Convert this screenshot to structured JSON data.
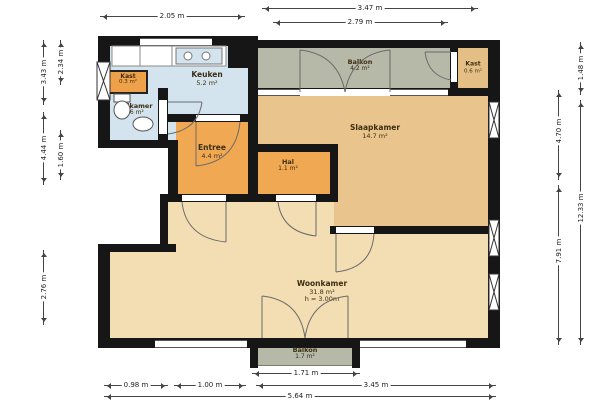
{
  "floorplan": {
    "rooms": {
      "kast_left": {
        "name": "Kast",
        "area": "0.3 m²"
      },
      "keuken": {
        "name": "Keuken",
        "area": "5.2 m²"
      },
      "badkamer": {
        "name": "Badkamer",
        "area": "2.6 m²"
      },
      "entree": {
        "name": "Entree",
        "area": "4.4 m²"
      },
      "hal": {
        "name": "Hal",
        "area": "1.1 m²"
      },
      "slaapkamer": {
        "name": "Slaapkamer",
        "area": "14.7 m²"
      },
      "balkon_top": {
        "name": "Balkon",
        "area": "4.2 m²"
      },
      "kast_right": {
        "name": "Kast",
        "area": "0.6 m²"
      },
      "woonkamer": {
        "name": "Woonkamer",
        "area": "31.8 m²",
        "height_note": "h = 3.00m"
      },
      "balkon_bottom": {
        "name": "Balkon",
        "area": "1.7 m²"
      }
    },
    "dims": {
      "top": [
        "2.05 m",
        "3.47 m",
        "2.79 m"
      ],
      "bottom": [
        "1.71 m",
        "0.98 m",
        "1.00 m",
        "3.45 m",
        "5.64 m"
      ],
      "left": [
        "2.34 m",
        "3.43 m",
        "4.44 m",
        "1.60 m",
        "2.76 m"
      ],
      "right": [
        "1.48 m",
        "4.70 m",
        "12.33 m",
        "7.91 m"
      ]
    },
    "colors": {
      "wall": "#161616",
      "wet_rooms": "#d3e4ee",
      "circulation": "#f0a952",
      "bedroom": "#eac48d",
      "living": "#f3ddb2",
      "balcony": "#b6b8a8",
      "closet": "#efa14a",
      "dimension_text": "#222222"
    }
  }
}
